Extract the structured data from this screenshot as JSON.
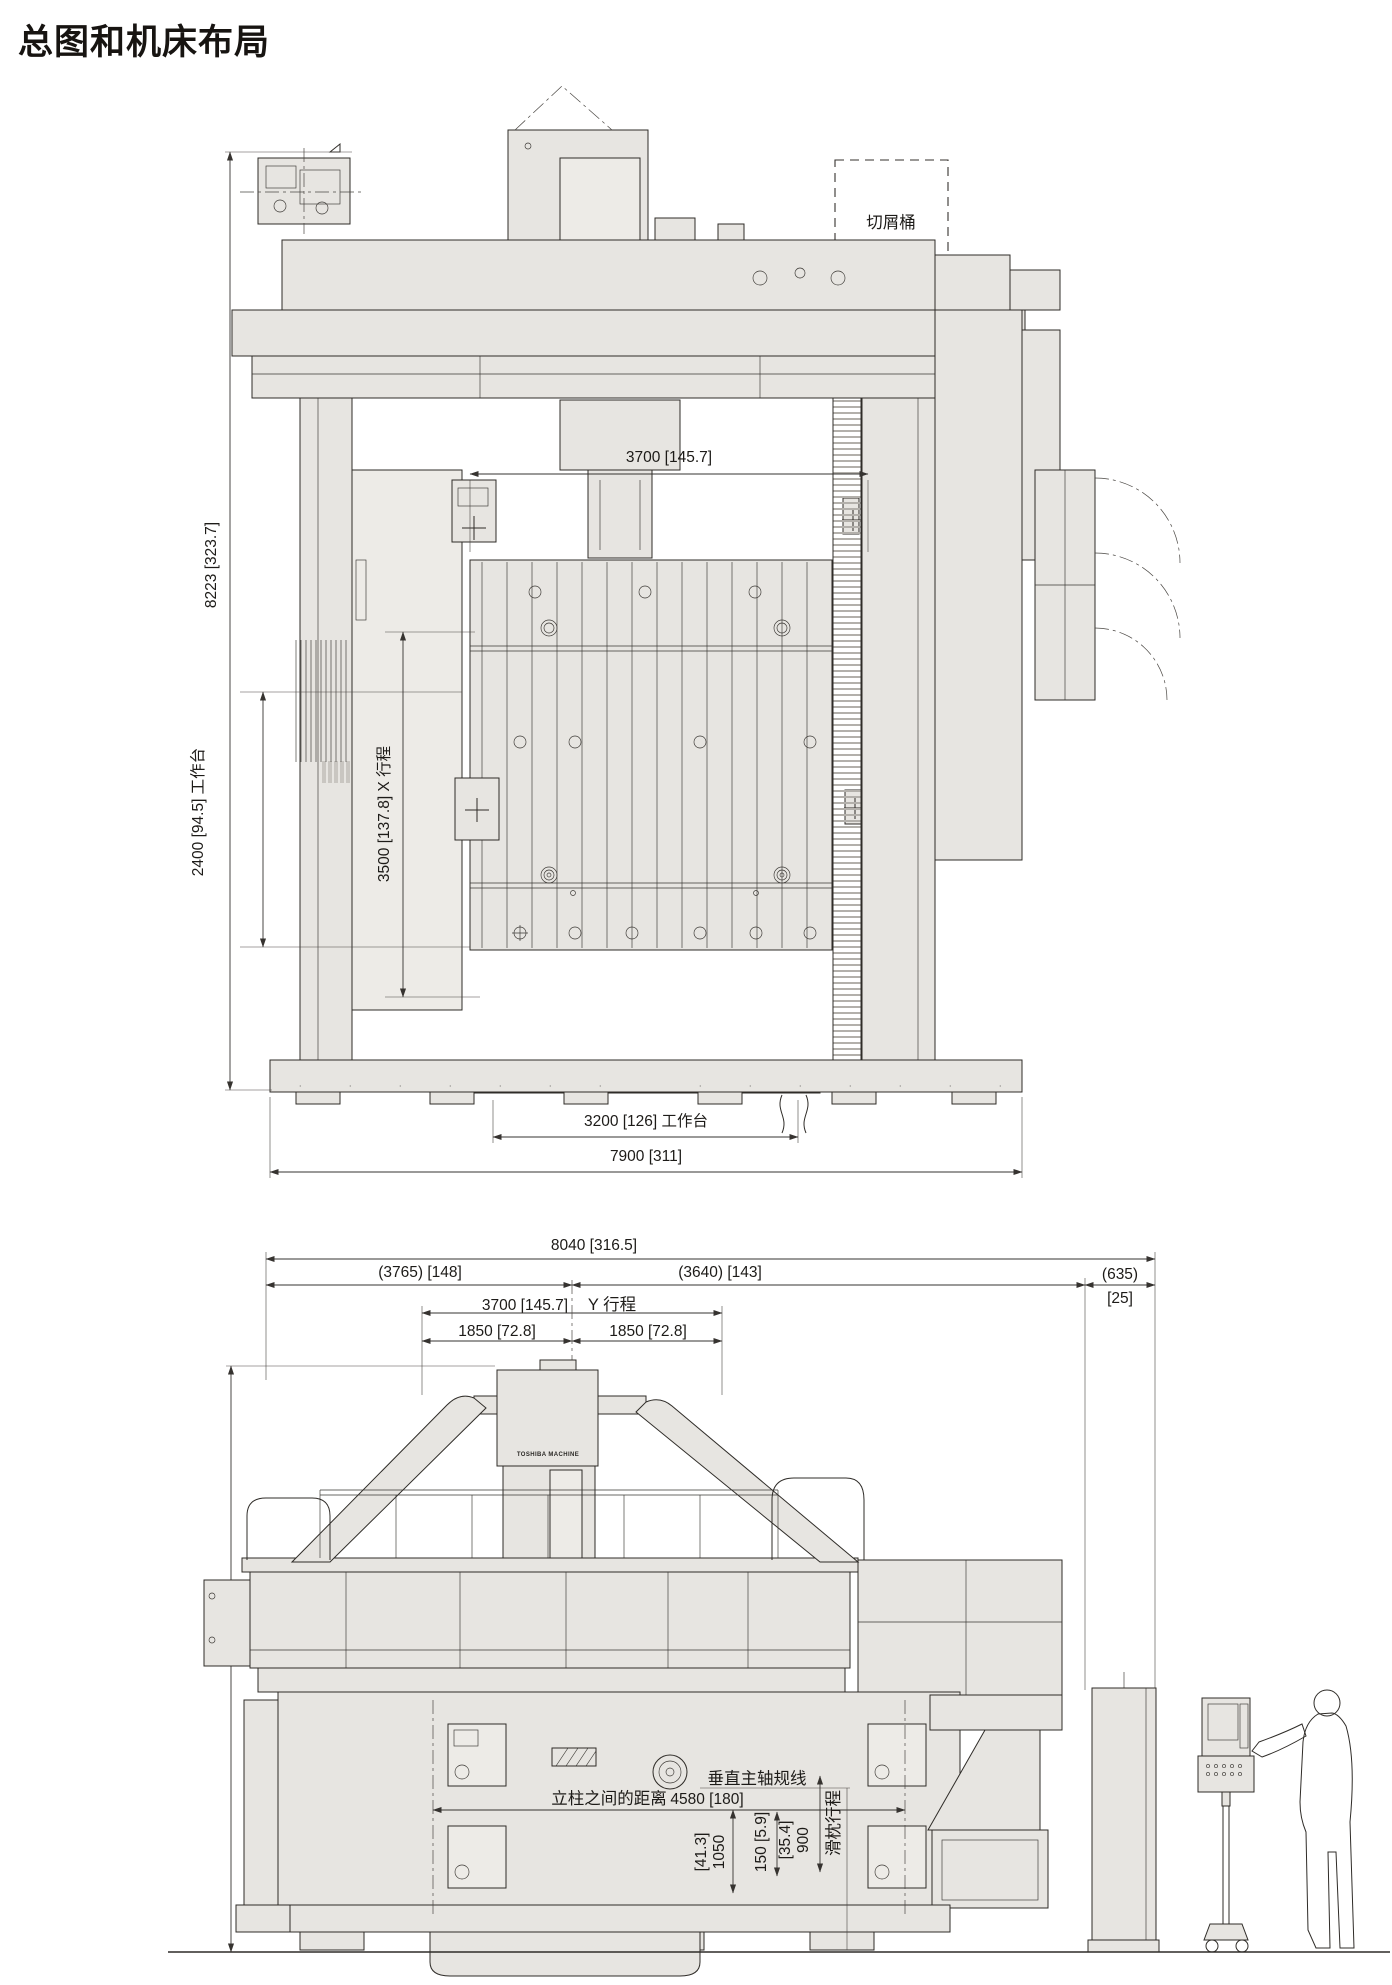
{
  "page": {
    "title": "总图和机床布局"
  },
  "front_view": {
    "chip_bucket": "切屑桶",
    "dim_height": "8223 [323.7]",
    "dim_table_depth": "2400 [94.5] 工作台",
    "dim_x_stroke": "3500 [137.8] X 行程",
    "dim_spindle_span": "3700 [145.7]",
    "dim_table_width": "3200 [126] 工作台",
    "dim_overall_width": "7900 [311]"
  },
  "side_view": {
    "dim_overall_length": "8040 [316.5]",
    "dim_front_segment": "(3765) [148]",
    "dim_rear_segment": "(3640) [143]",
    "dim_cabinet_gap_mm": "(635)",
    "dim_cabinet_gap_in": "[25]",
    "dim_y_stroke": "3700 [145.7]",
    "label_y_stroke": "Y 行程",
    "dim_y_half_left": "1850 [72.8]",
    "dim_y_half_right": "1850 [72.8]",
    "dim_height": "4900 [193]",
    "brand": "TOSHIBA MACHINE",
    "label_column_distance": "立柱之间的距离",
    "dim_column_distance": "4580 [180]",
    "label_spindle_gauge_line": "垂直主轴规线",
    "dim_gauge_in": "[41.3]",
    "dim_gauge_mm": "1050",
    "dim_clearance": "150 [5.9]",
    "dim_ram_in": "[35.4]",
    "dim_ram_mm": "900",
    "label_ram_stroke": "滑枕行程"
  }
}
